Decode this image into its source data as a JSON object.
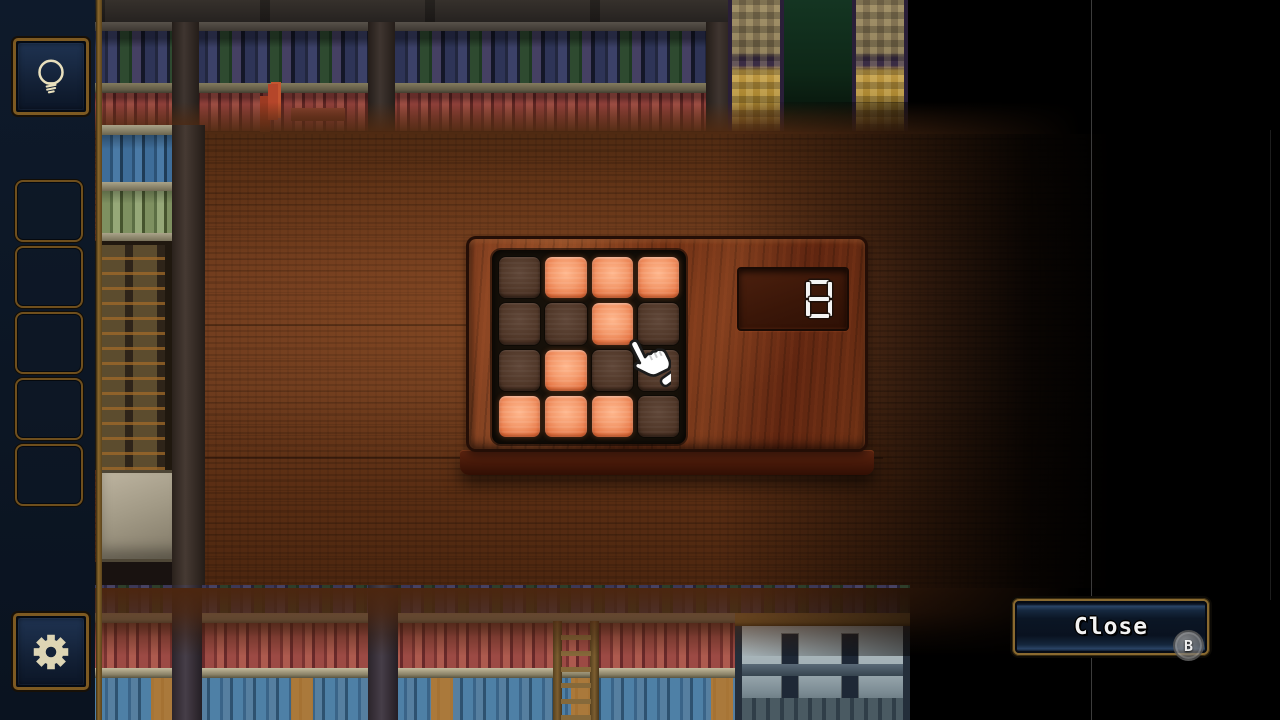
{
  "app": {
    "type": "puzzle-game-screen",
    "scene": "library-table"
  },
  "theme": {
    "sidebar_bg": "#0d1826",
    "frame_gold": "#7d5a22",
    "slot_border": "#6f4f1d",
    "icon_color": "#e2d9b6",
    "cell_lit_color": "#f0946a",
    "cell_unlit_color": "#4e3829",
    "board_wood_color": "#7a3a1d",
    "grid_panel_color": "#161009",
    "display_bg_color": "#3a1608",
    "digit_color": "#f2f2f2",
    "close_border_color": "#8a6a30",
    "close_bg_color": "#0b1625",
    "table_wood_color": "#6b3a1d",
    "vignette_color": "#000000"
  },
  "sidebar": {
    "hint_button": {
      "icon": "lightbulb-icon"
    },
    "inventory": {
      "slots": [
        "empty",
        "empty",
        "empty",
        "empty",
        "empty"
      ]
    },
    "settings_button": {
      "icon": "gear-icon"
    }
  },
  "puzzle": {
    "grid": {
      "rows": 4,
      "cols": 4,
      "lit_pattern": [
        [
          0,
          1,
          1,
          1
        ],
        [
          0,
          0,
          1,
          0
        ],
        [
          0,
          1,
          0,
          0
        ],
        [
          1,
          1,
          1,
          0
        ]
      ]
    },
    "lit_count": 8,
    "display": {
      "value": "8",
      "style": "seven-segment"
    }
  },
  "cursor": {
    "icon": "hand-pointer-icon",
    "position": {
      "x": 629,
      "y": 344
    }
  },
  "close_button": {
    "label": "Close",
    "gamepad_hint": "B"
  }
}
